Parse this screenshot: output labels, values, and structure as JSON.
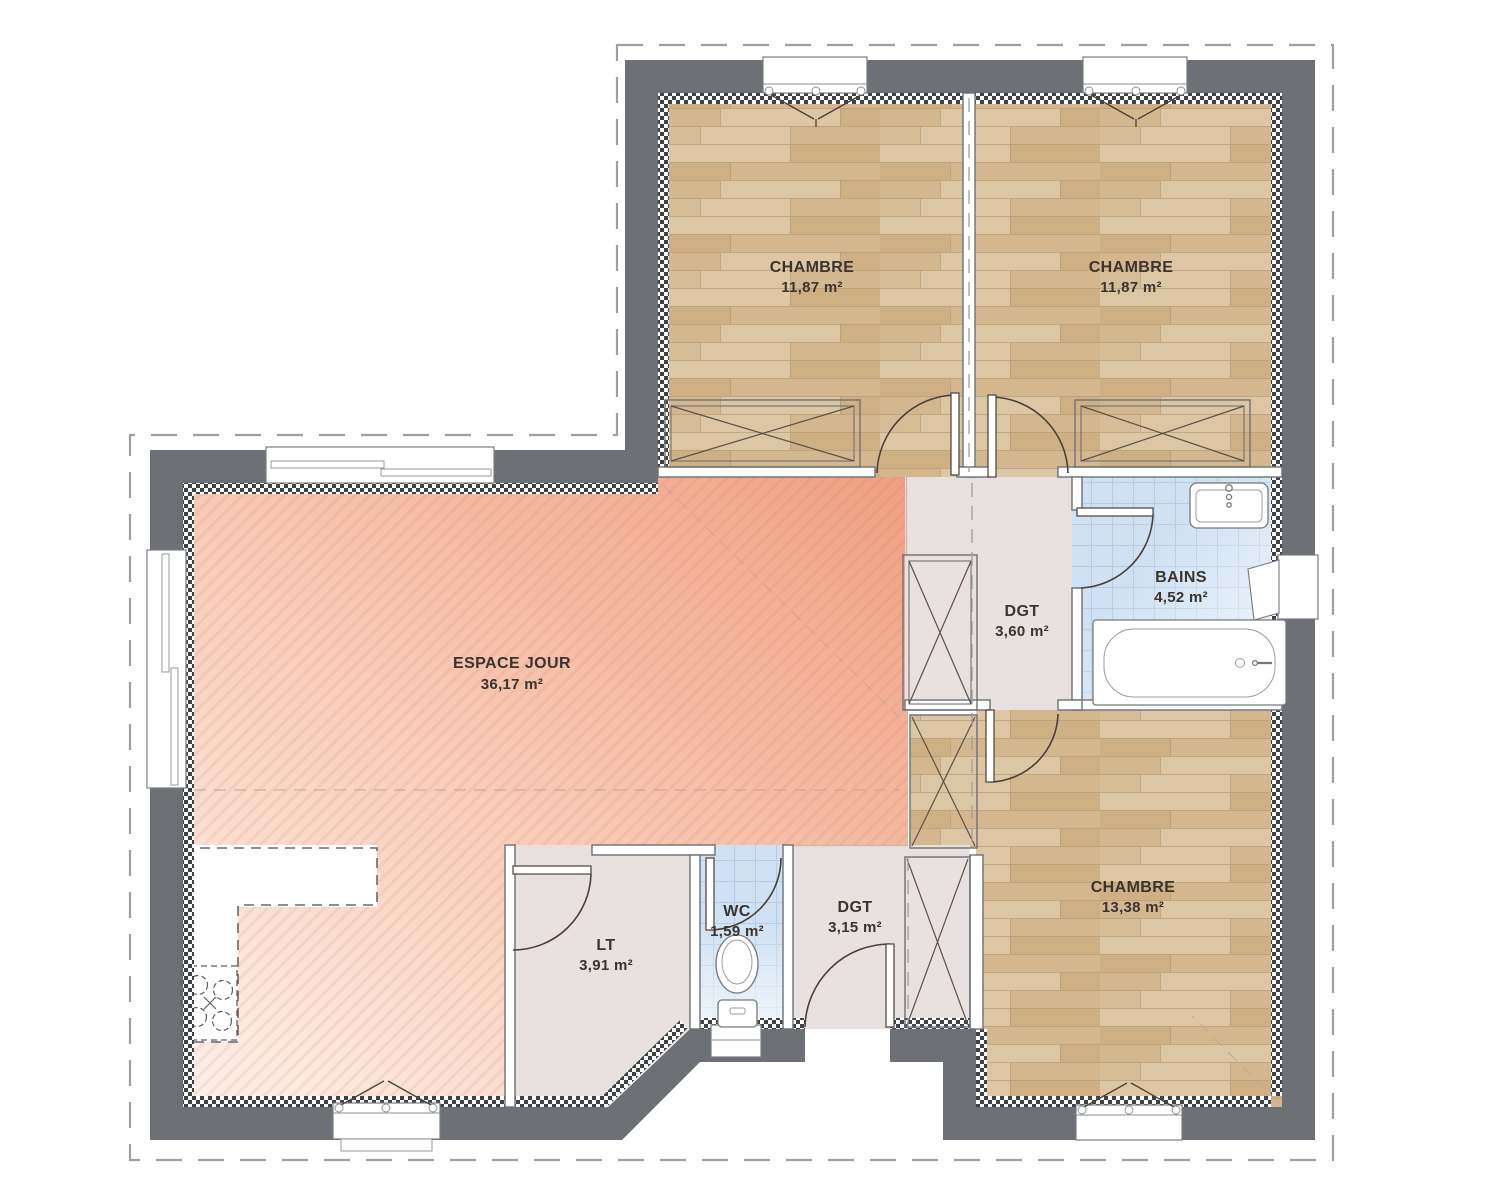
{
  "plan": {
    "rooms": {
      "chambre1": {
        "name": "CHAMBRE",
        "area": "11,87 m²"
      },
      "chambre2": {
        "name": "CHAMBRE",
        "area": "11,87 m²"
      },
      "chambre3": {
        "name": "CHAMBRE",
        "area": "13,38 m²"
      },
      "espace_jour": {
        "name": "ESPACE JOUR",
        "area": "36,17 m²"
      },
      "bains": {
        "name": "BAINS",
        "area": "4,52 m²"
      },
      "dgt_haut": {
        "name": "DGT",
        "area": "3,60 m²"
      },
      "dgt_entree": {
        "name": "DGT",
        "area": "3,15 m²"
      },
      "wc": {
        "name": "WC",
        "area": "1,59 m²"
      },
      "lt": {
        "name": "LT",
        "area": "3,91 m²"
      }
    },
    "colors": {
      "exterior_wall": "#6d7175",
      "wood_floor": "#d7bd97",
      "living_floor_light": "#fdf1ea",
      "living_floor_deep": "#efa083",
      "tile_floor": "#cfe1f2",
      "hall_floor": "#e9e1df",
      "label_text": "#3a332e",
      "boundary_dash": "#9ba0a4"
    }
  }
}
